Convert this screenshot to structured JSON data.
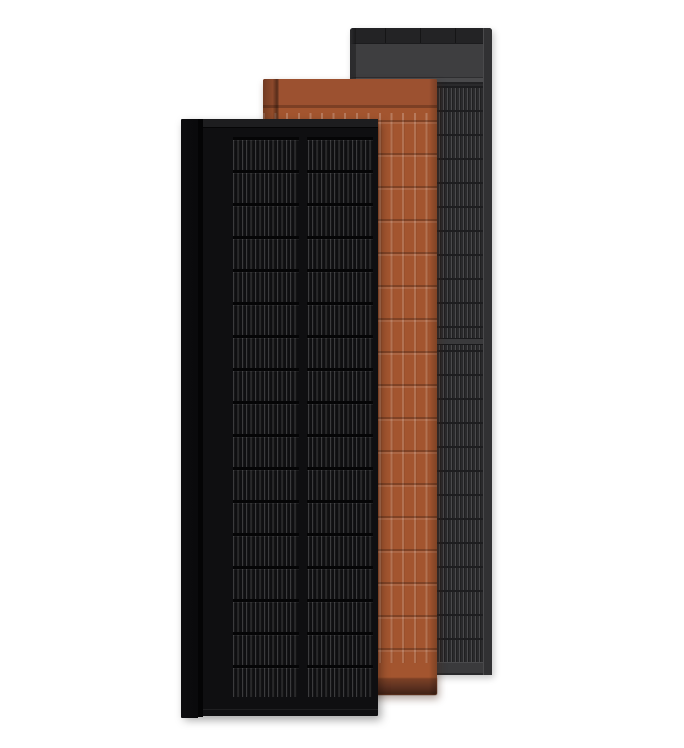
{
  "scene": {
    "description": "Product render of three overlapping tall rectangular roof-integrated solar panels on a white background: a black solar panel in front, a terracotta ridged panel in the middle, and a dark gray striped panel at the back",
    "background_color": "#ffffff"
  },
  "colors": {
    "background": "#ffffff",
    "black_face": "#0f0f11",
    "black_frame_top": "#1d1d1f",
    "black_side": "#0c0c0e",
    "black_groove": "#040405",
    "black_cell_line": "#3b3b3d",
    "black_row_divider": "#050506",
    "terra_face": "#a3552f",
    "terra_header": "#9c5130",
    "terra_seam": "#7c3f24",
    "terra_bottom_band": "#5c3020",
    "terra_edge_shade": "#7e4226",
    "gray_face": "#2a2a2c",
    "gray_header": "#3e3e40",
    "gray_top_cap": "#232325",
    "gray_cell_line": "#4a4a4c",
    "gray_frame": "#3a3a3c",
    "gray_row_divider": "#1d1d1f",
    "gray_edge": "#2c2c2e"
  },
  "panels": [
    {
      "name": "black-solar-panel",
      "position": "front"
    },
    {
      "name": "terracotta-solar-panel",
      "position": "middle"
    },
    {
      "name": "gray-solar-panel",
      "position": "back"
    }
  ]
}
